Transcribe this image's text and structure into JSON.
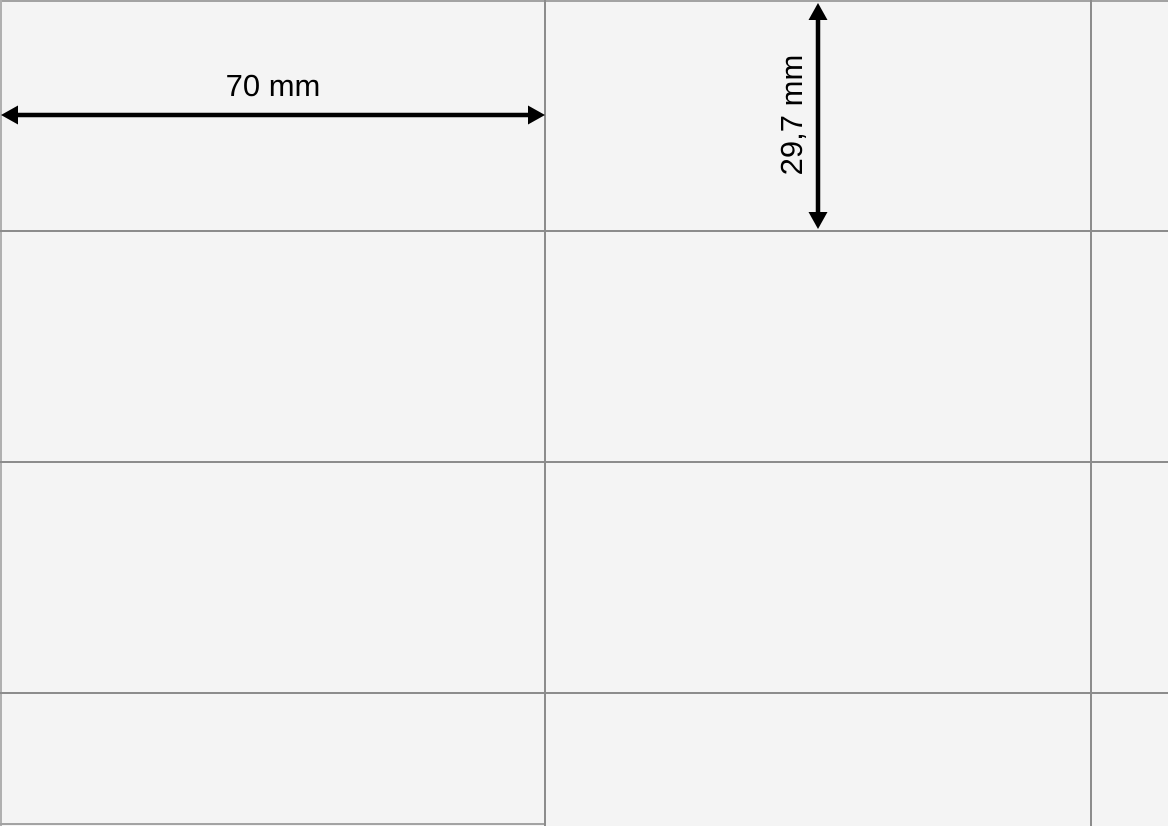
{
  "diagram": {
    "description": "Label sheet dimension diagram (cropped view of a sheet of identical labels)",
    "dimensions": {
      "width": {
        "label": "70 mm",
        "value_mm": 70,
        "orientation": "horizontal"
      },
      "height": {
        "label": "29,7 mm",
        "value_mm": 29.7,
        "orientation": "vertical"
      }
    },
    "grid": {
      "columns_visible": 3,
      "rows_visible": 4,
      "rightmost_column_cut_off": true,
      "bottom_row_cut_off": true
    },
    "icons": {
      "width_arrow": "horizontal-double-arrow-icon",
      "height_arrow": "vertical-double-arrow-icon"
    },
    "colors": {
      "background": "#f4f4f4",
      "grid_line": "#8c8c8c",
      "outer_border": "#a3a3a3",
      "dimension_arrow": "#000000",
      "dimension_text": "#000000"
    }
  }
}
